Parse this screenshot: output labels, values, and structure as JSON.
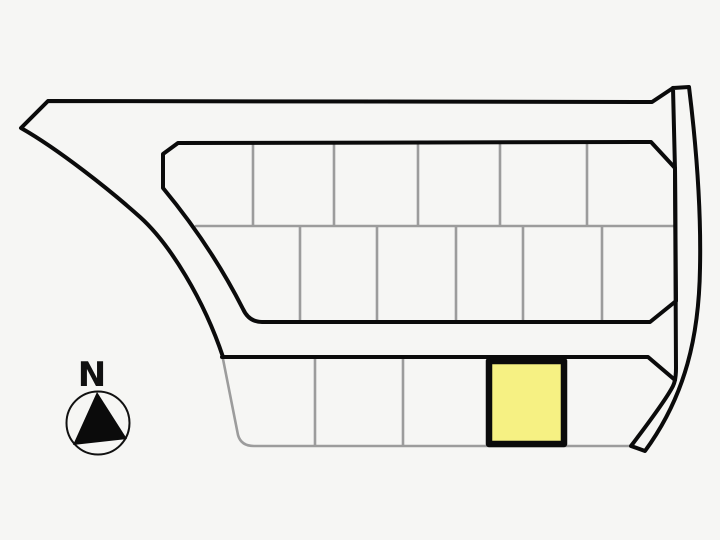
{
  "compass": {
    "label": "N"
  },
  "colors": {
    "background": "#f6f6f4",
    "boundary": "#0b0b0b",
    "divider": "#9c9c9c",
    "highlight_fill": "#f6f183",
    "compass_stroke": "#111111"
  },
  "plot_map": {
    "rows": [
      {
        "name": "north row",
        "lot_count": 6
      },
      {
        "name": "middle row",
        "lot_count": 6
      },
      {
        "name": "south row",
        "lot_count": 5
      }
    ],
    "highlighted_lot": {
      "row": "south row",
      "position_from_left": 4
    }
  }
}
